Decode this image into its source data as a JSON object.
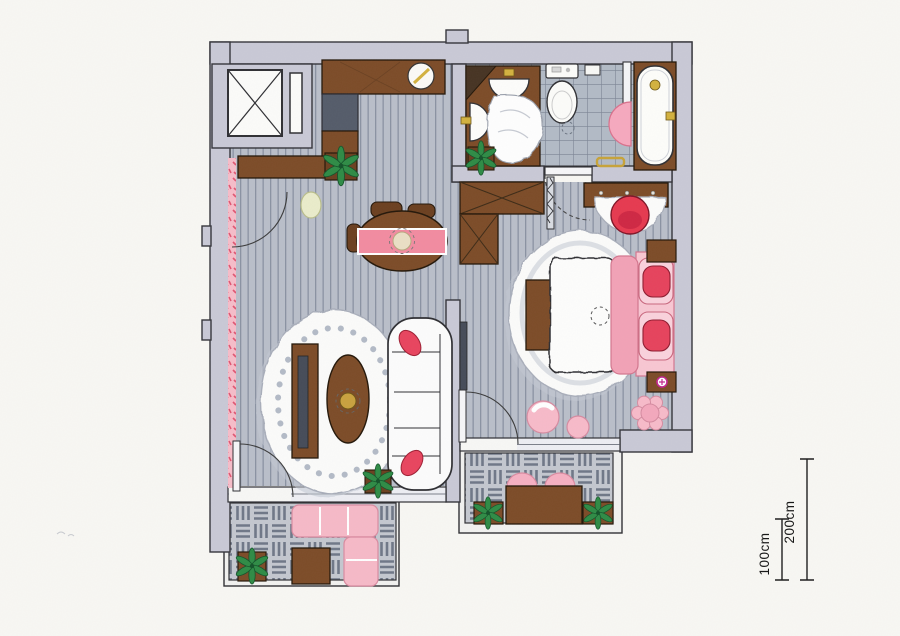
{
  "page": {
    "type": "floor-plan",
    "description": "hand-drawn hotel suite floor plan, colored pencil style",
    "background": "#f8f7f3"
  },
  "scale_indicator": {
    "bars": [
      {
        "label": "100cm"
      },
      {
        "label": "200cm"
      }
    ]
  },
  "palette": {
    "wall": "#c9c9d6",
    "outline": "#2f2f33",
    "wood_floor": "#b9bec9",
    "floor_stripe": "#8a92a2",
    "bathroom_tile": "#b2bac5",
    "paver_tile": "#c3c7cf",
    "furniture_wood": "#7c4b27",
    "dark_wood": "#6b3f1f",
    "appliance_gray": "#545b69",
    "textile_pink": "#f6b9c7",
    "blanket_pink": "#f2a2b6",
    "accent_crimson": "#e6425c",
    "plant_green": "#2e8b45",
    "fixture_gold": "#d3b13e",
    "outlet_magenta": "#c2268f",
    "paper": "#f8f7f3"
  },
  "rooms": [
    {
      "name": "entry-corridor",
      "items": [
        "elevator",
        "shaft-door",
        "kitchenette-counter",
        "counter-bowl",
        "minibar-fridge",
        "base-cabinet",
        "console-shelf",
        "stool",
        "pink-curtain",
        "potted-plant",
        "door-swing"
      ]
    },
    {
      "name": "bathroom",
      "items": [
        "double-vanity",
        "corner-shelf",
        "washbasin-top",
        "washbasin-side",
        "towel",
        "toilet",
        "toilet-paper-holder",
        "floor-drain",
        "shower-screen",
        "pink-bath-mat",
        "bathtub",
        "towel-rail",
        "potted-plant",
        "sliding-door",
        "door-swing"
      ]
    },
    {
      "name": "living-room",
      "items": [
        "dining-table",
        "table-runner",
        "serving-plate",
        "dining-chair",
        "dining-chair",
        "dining-chair",
        "scalloped-rug",
        "coffee-table",
        "tv-console",
        "television",
        "sofa",
        "accent-cushion",
        "accent-cushion",
        "potted-plant",
        "balcony-door"
      ]
    },
    {
      "name": "bedroom",
      "items": [
        "wardrobe",
        "folding-door",
        "wall-tv",
        "double-bed",
        "pillow",
        "pillow",
        "accent-cushion",
        "accent-cushion",
        "bed-runner",
        "scalloped-rug",
        "bed-bench",
        "nightstand",
        "nightstand",
        "power-outlet",
        "dressing-table",
        "vanity-rug",
        "vanity-chair",
        "pouf",
        "pouf",
        "flower-pouf",
        "balcony-door"
      ]
    },
    {
      "name": "balcony-lounge",
      "items": [
        "paver-floor",
        "outdoor-corner-sofa",
        "outdoor-table",
        "potted-plant"
      ]
    },
    {
      "name": "balcony-dining",
      "items": [
        "paver-floor",
        "outdoor-table",
        "outdoor-chair",
        "outdoor-chair",
        "planter",
        "planter"
      ]
    }
  ]
}
